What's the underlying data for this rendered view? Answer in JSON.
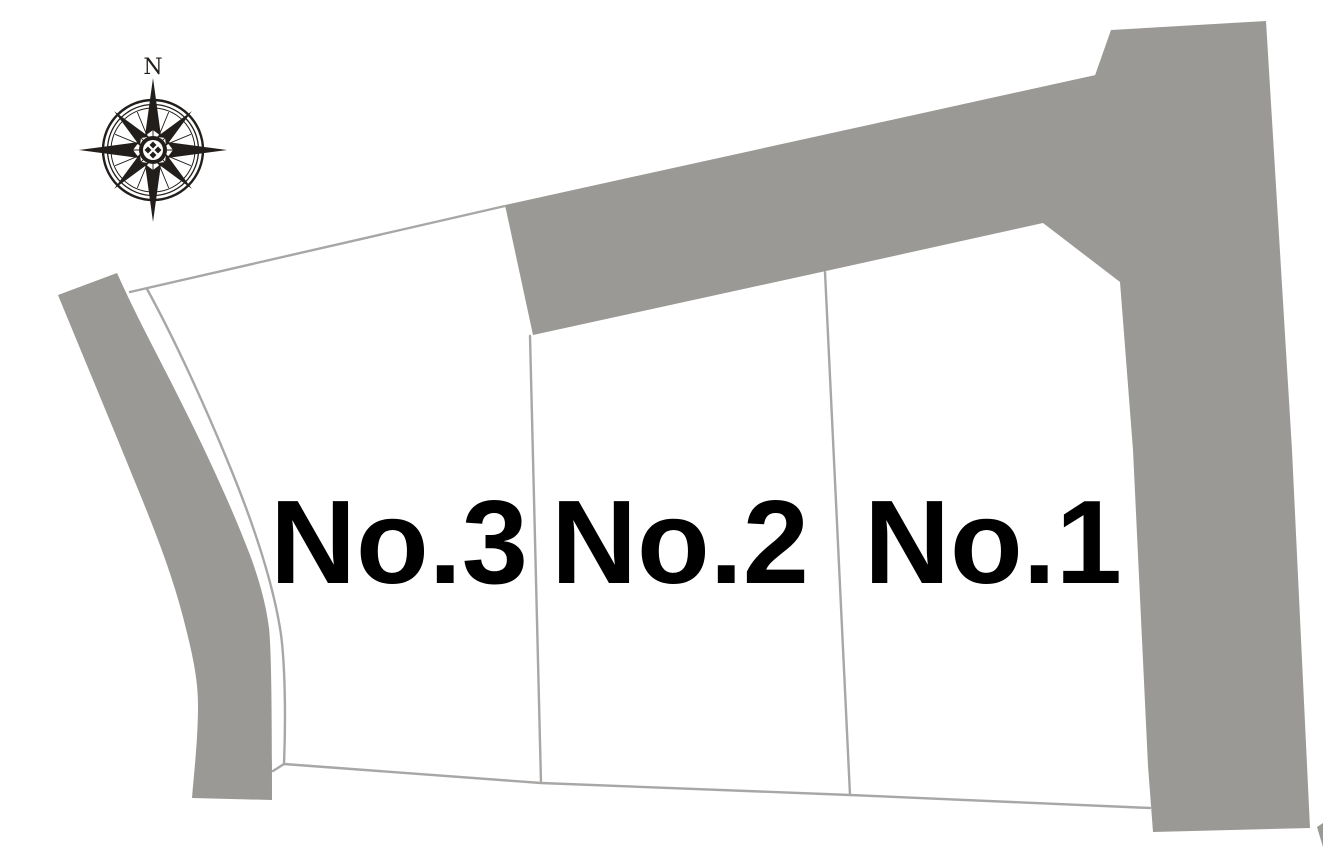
{
  "map": {
    "type": "residential-lot-site-plan",
    "parcels": [
      {
        "label": "No.1"
      },
      {
        "label": "No.2"
      },
      {
        "label": "No.3"
      }
    ],
    "compass": {
      "north_label": "N"
    }
  },
  "colors": {
    "background": "#ffffff",
    "road_fill": "#9b9996",
    "parcel_fill": "#ffffff",
    "boundary_line": "#a9a7a5",
    "label_text": "#000000",
    "compass_ink": "#221e1b"
  }
}
